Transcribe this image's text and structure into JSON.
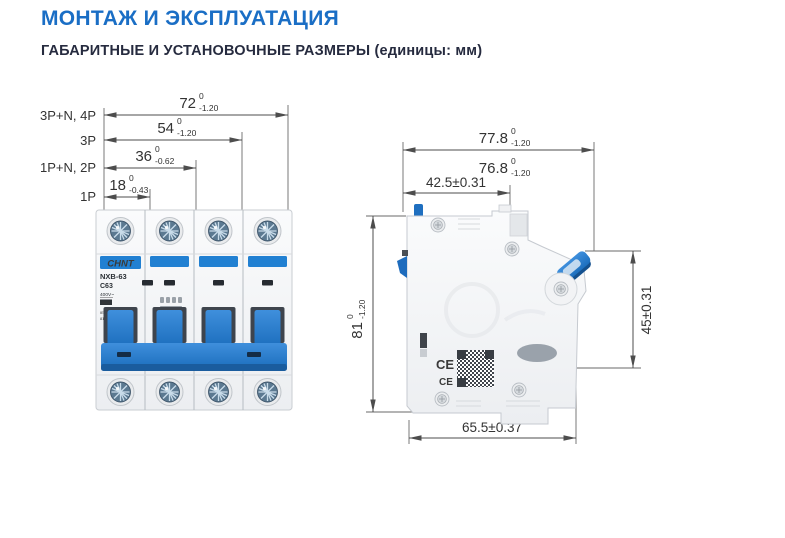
{
  "page": {
    "title": "МОНТАЖ И ЭКСПЛУАТАЦИЯ",
    "subtitle": "ГАБАРИТНЫЕ И УСТАНОВОЧНЫЕ РАЗМЕРЫ (единицы: мм)"
  },
  "front_view": {
    "rows": [
      {
        "pole": "3P+N, 4P",
        "value": "72",
        "tol_top": "0",
        "tol_bot": "-1.20"
      },
      {
        "pole": "3P",
        "value": "54",
        "tol_top": "0",
        "tol_bot": "-1.20"
      },
      {
        "pole": "1P+N, 2P",
        "value": "36",
        "tol_top": "0",
        "tol_bot": "-0.62"
      },
      {
        "pole": "1P",
        "value": "18",
        "tol_top": "0",
        "tol_bot": "-0.43"
      }
    ],
    "device": {
      "brand": "CHNT",
      "model": "NXB-63",
      "rating": "C63",
      "voltage": "400V~",
      "breaking_capacity": "6000",
      "standard": "IEC/EN60898-1",
      "code": "814254",
      "on_label": "I ON",
      "off_label": "O OFF"
    }
  },
  "side_view": {
    "overall_width": {
      "value": "77.8",
      "tol_top": "0",
      "tol_bot": "-1.20"
    },
    "body_width": {
      "value": "76.8",
      "tol_top": "0",
      "tol_bot": "-1.20"
    },
    "mount_depth": "42.5±0.31",
    "height": {
      "value": "81",
      "tol_top": "0",
      "tol_bot": "-1.20"
    },
    "front_height": "45±0.31",
    "base_depth": "65.5±0.37",
    "ce_marks": [
      "CE",
      "CE"
    ]
  },
  "colors": {
    "title_blue": "#1a6ec5",
    "subtitle_navy": "#262b3f",
    "breaker_blue": "#2180d2",
    "drawing_line": "#4d4d4d"
  }
}
